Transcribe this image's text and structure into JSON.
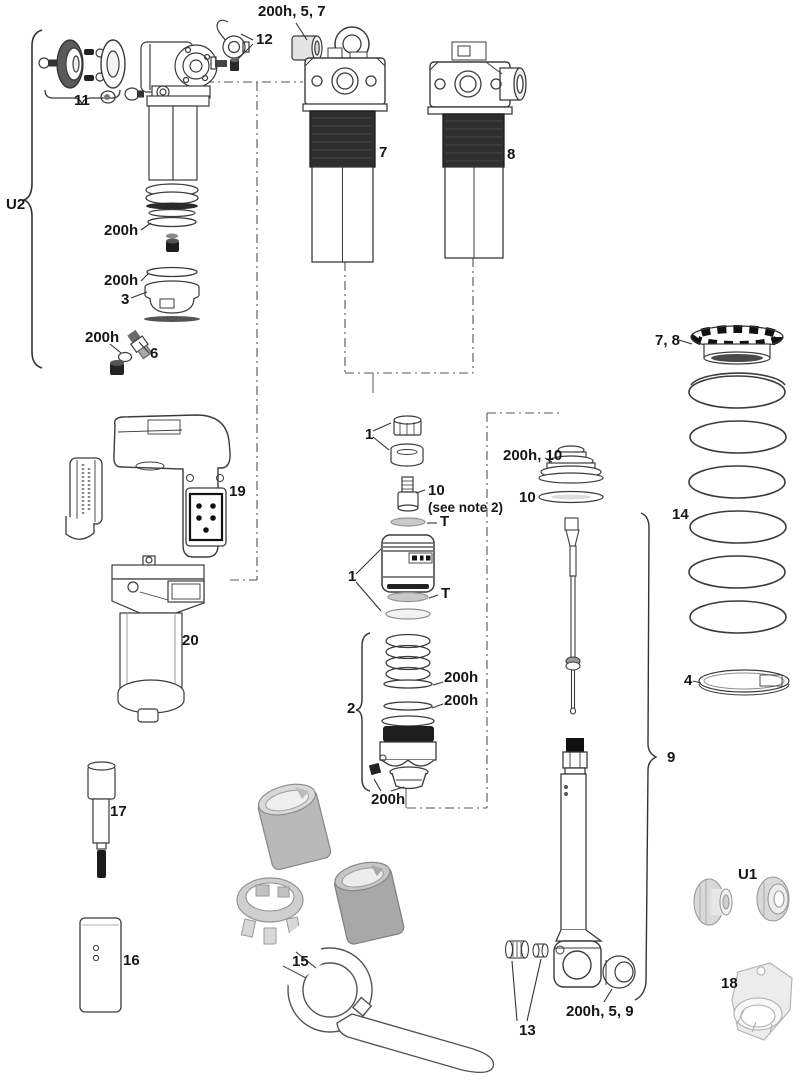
{
  "document": {
    "type": "exploded-parts-diagram",
    "subject": "Rear shock exploded service parts view",
    "background": "#ffffff",
    "line_color": "#3b3b3b",
    "dark_fill": "#2b2b2b",
    "tool_gray": "#c2c2c2"
  },
  "callouts": {
    "u2": "U2",
    "n11": "11",
    "n12": "12",
    "top_bushing": "200h, 5, 7",
    "n7": "7",
    "n8": "8",
    "seal_a": "200h",
    "seal_b": "200h",
    "n3": "3",
    "seal_c": "200h",
    "n6": "6",
    "n1a": "1",
    "n10a": "10",
    "note2": "(see note 2)",
    "t_a": "T",
    "n1b": "1",
    "t_b": "T",
    "bumper": "200h, 10",
    "n10b": "10",
    "n19": "19",
    "n20": "20",
    "n2": "2",
    "seal_d": "200h",
    "seal_e": "200h",
    "seal_f": "200h",
    "n78": "7, 8",
    "n14": "14",
    "n4": "4",
    "n9": "9",
    "n17": "17",
    "n16": "16",
    "n15": "15",
    "n13": "13",
    "eyelet_bushing": "200h, 5, 9",
    "u1": "U1",
    "n18": "18"
  }
}
